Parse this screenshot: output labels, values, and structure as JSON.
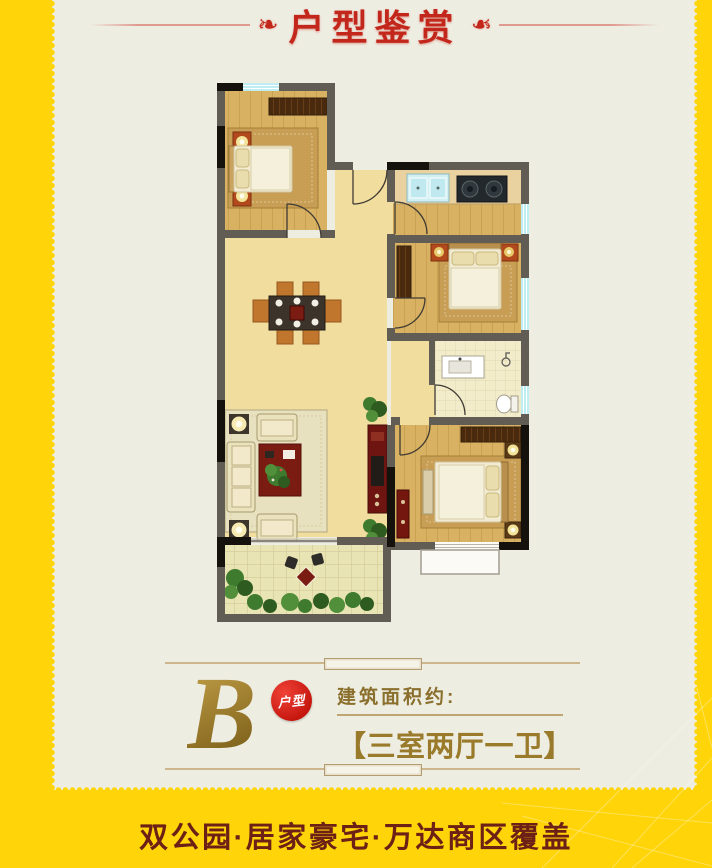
{
  "header": {
    "title": "户型鉴赏",
    "ornament": "❧"
  },
  "unit_info": {
    "letter": "B",
    "badge_label": "户型",
    "area_label": "建筑面积约:",
    "layout_value": "【三室两厅一卫】"
  },
  "footer": {
    "slogan": "双公园·居家豪宅·万达商区覆盖"
  },
  "floorplan": {
    "type": "apartment-floor-plan",
    "rooms": [
      "master-bedroom",
      "entry-foyer",
      "kitchen",
      "bedroom-2",
      "bathroom",
      "bedroom-3",
      "living-room",
      "dining-area",
      "balcony",
      "bay-window"
    ]
  },
  "colors": {
    "frame_yellow": "#ffd408",
    "canvas_cream": "#eeede2",
    "title_red": "#c3261b",
    "gold_text": "#9a7b2c",
    "badge_red": "#c8170f",
    "slogan_maroon": "#6d2015",
    "wall_gray": "#615c54",
    "wall_black": "#15120e",
    "window_cyan": "#bfeef2",
    "wood_floor": "#d9b162",
    "living_floor": "#f1dd9e",
    "balcony_tile": "#e9e4b8"
  }
}
